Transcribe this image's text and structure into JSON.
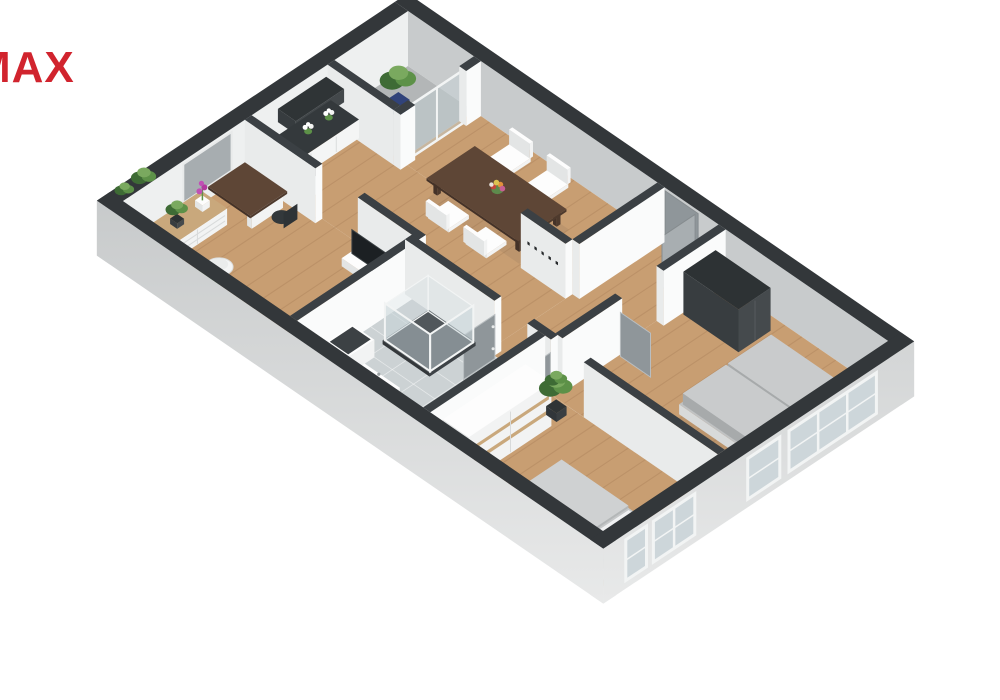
{
  "logo": {
    "text": "MAX",
    "color": "#d1242e"
  },
  "scene": {
    "palette": {
      "wall_top": "#33373a",
      "wall_top_inner": "#3b4044",
      "wall_white": "#fafbfb",
      "wall_white_shade": "#e9ebeb",
      "wall_ne_inner": "#c8cbcc",
      "wall_nw_inner": "#eef0f0",
      "exterior_top": "#bec1c2",
      "exterior_bottom": "#ebecec",
      "floor_wood": "#c89e72",
      "floor_wood_line": "#7d5030",
      "floor_tile": "#ccd2d4",
      "floor_tile_line": "#ffffff",
      "floor_loggia": "#b3b6b7",
      "white_top": "#fdfdfd",
      "white_face": "#f2f3f3",
      "white_side": "#e3e5e5",
      "dark_top": "#2d3234",
      "dark_face": "#454a4d",
      "dark_side": "#383d40",
      "walnut_top": "#5e4636",
      "walnut_face": "#4e3a2d",
      "walnut_side": "#443228",
      "wood_light": "#c9a87c",
      "sofa_top": "#c9cbcc",
      "sofa_face": "#b0b3b4",
      "sofa_side": "#a7aaab",
      "sofa_base": "#e4e6e6",
      "bed_top": "#c6c8c9",
      "bed_face": "#aeb1b2",
      "glass": "rgba(198,210,216,0.45)",
      "glass_frame": "#f2f4f4",
      "window_glass": "#cdd6da",
      "niche_glass": "#a7adb0",
      "door_gray": "#8f969a",
      "door_gray_edge": "#b9bec1",
      "tv_black": "#1c2023",
      "green_dark": "#3e6b35",
      "green": "#5d9148",
      "green_light": "#7aa95f",
      "pot_blue": "#3d5390",
      "pot_dark": "#3a3f42",
      "orchid": "#c050b5",
      "bouquet": [
        "#c5453a",
        "#e2903c",
        "#ddc250",
        "#c75f93"
      ],
      "counter_top": "#34393c",
      "shadow": "rgba(50,50,50,0.08)"
    },
    "rooms": [
      {
        "name": "balcony"
      },
      {
        "name": "kitchen"
      },
      {
        "name": "dining-room"
      },
      {
        "name": "hall"
      },
      {
        "name": "living-room"
      },
      {
        "name": "home-office"
      },
      {
        "name": "bathroom"
      },
      {
        "name": "bedroom"
      }
    ],
    "elements": [
      {
        "name": "ne-wall"
      },
      {
        "name": "nw-wall"
      },
      {
        "name": "nw-window-niche"
      },
      {
        "name": "windowsill-plants"
      },
      {
        "name": "loggia-floor"
      },
      {
        "name": "main-floor"
      },
      {
        "name": "hall-floor"
      },
      {
        "name": "living-floor"
      },
      {
        "name": "office-floor"
      },
      {
        "name": "bathroom-floor"
      },
      {
        "name": "bedroom-floor"
      },
      {
        "name": "balcony-plant"
      },
      {
        "name": "balcony-glass-door"
      },
      {
        "name": "loggia-walls"
      },
      {
        "name": "kitchen-wall-cabinet"
      },
      {
        "name": "kitchen-counter"
      },
      {
        "name": "dining-chairs-far"
      },
      {
        "name": "dining-table"
      },
      {
        "name": "table-bouquet"
      },
      {
        "name": "dining-chairs-near"
      },
      {
        "name": "entry-door"
      },
      {
        "name": "dining-hall-wall"
      },
      {
        "name": "coat-rack-wall"
      },
      {
        "name": "coat-hooks"
      },
      {
        "name": "office-top-wall"
      },
      {
        "name": "tv-lowboard"
      },
      {
        "name": "tv"
      },
      {
        "name": "desk"
      },
      {
        "name": "desk-chair"
      },
      {
        "name": "dresser"
      },
      {
        "name": "orchid"
      },
      {
        "name": "dresser-plant"
      },
      {
        "name": "round-chair"
      },
      {
        "name": "office-plant"
      },
      {
        "name": "side-table"
      },
      {
        "name": "office-right-wall"
      },
      {
        "name": "hall-living-wall"
      },
      {
        "name": "living-door"
      },
      {
        "name": "hall-closet"
      },
      {
        "name": "sofa"
      },
      {
        "name": "radiator"
      },
      {
        "name": "south-wall"
      },
      {
        "name": "bathroom-door"
      },
      {
        "name": "bedroom-door"
      },
      {
        "name": "washing-machine"
      },
      {
        "name": "shower"
      },
      {
        "name": "vanity"
      },
      {
        "name": "bathroom-bedroom-wall"
      },
      {
        "name": "wardrobe"
      },
      {
        "name": "bedroom-plant"
      },
      {
        "name": "bed"
      },
      {
        "name": "sw-wall"
      },
      {
        "name": "se-wall"
      },
      {
        "name": "se-windows"
      }
    ]
  }
}
